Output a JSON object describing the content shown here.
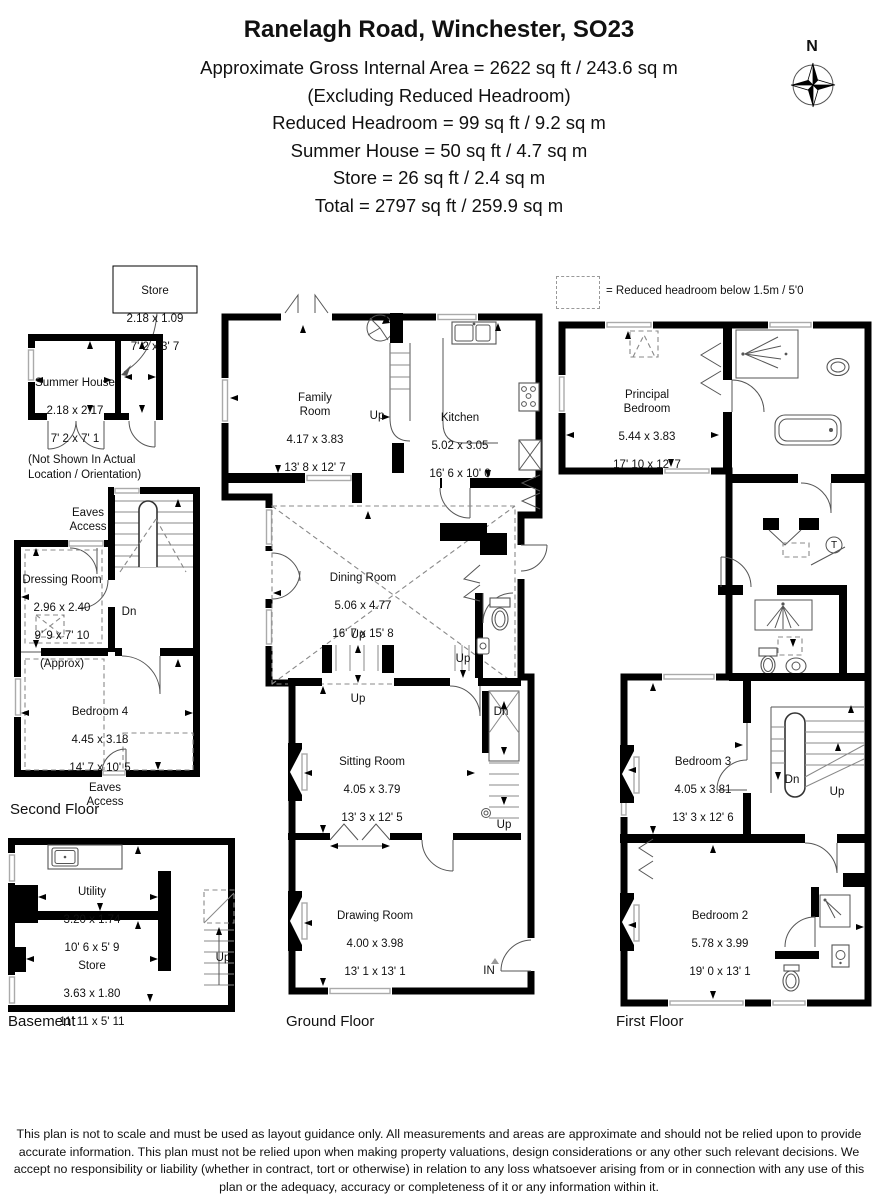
{
  "header": {
    "title": "Ranelagh Road, Winchester, SO23",
    "lines": [
      "Approximate Gross Internal Area = 2622 sq ft / 243.6 sq m",
      "(Excluding Reduced Headroom)",
      "Reduced Headroom = 99 sq ft / 9.2 sq m",
      "Summer House = 50 sq ft / 4.7 sq m",
      "Store = 26 sq ft / 2.4 sq m",
      "Total = 2797 sq ft / 259.9 sq m"
    ]
  },
  "compass": {
    "north": "N"
  },
  "legend": {
    "text": "= Reduced headroom below 1.5m / 5'0"
  },
  "floors": {
    "second": "Second Floor",
    "basement": "Basement",
    "ground": "Ground Floor",
    "first": "First Floor"
  },
  "outbuilding": {
    "store": {
      "name": "Store",
      "metric": "2.18 x 1.09",
      "imperial": "7' 2 x 3' 7"
    },
    "summer_house": {
      "name": "Summer House",
      "metric": "2.18 x 2.17",
      "imperial": "7' 2 x 7' 1"
    },
    "note": "(Not Shown In Actual\nLocation / Orientation)"
  },
  "rooms": {
    "dressing_room": {
      "name": "Dressing Room",
      "metric": "2.96 x 2.40",
      "imperial": "9' 9 x 7' 10",
      "note": "(Approx)"
    },
    "bedroom_4": {
      "name": "Bedroom 4",
      "metric": "4.45 x 3.18",
      "imperial": "14' 7 x 10' 5"
    },
    "utility": {
      "name": "Utility",
      "metric": "3.20 x 1.74",
      "imperial": "10' 6 x 5' 9"
    },
    "store_basement": {
      "name": "Store",
      "metric": "3.63 x 1.80",
      "imperial": "11' 11 x 5' 11"
    },
    "family_room": {
      "name": "Family\nRoom",
      "metric": "4.17 x 3.83",
      "imperial": "13' 8 x 12' 7"
    },
    "kitchen": {
      "name": "Kitchen",
      "metric": "5.02 x 3.05",
      "imperial": "16' 6 x 10' 0"
    },
    "dining_room": {
      "name": "Dining Room",
      "metric": "5.06 x 4.77",
      "imperial": "16' 7 x 15' 8"
    },
    "sitting_room": {
      "name": "Sitting Room",
      "metric": "4.05 x 3.79",
      "imperial": "13' 3 x 12' 5"
    },
    "drawing_room": {
      "name": "Drawing Room",
      "metric": "4.00 x 3.98",
      "imperial": "13' 1 x 13' 1"
    },
    "principal_bedroom": {
      "name": "Principal\nBedroom",
      "metric": "5.44 x 3.83",
      "imperial": "17' 10 x 12' 7"
    },
    "bedroom_3": {
      "name": "Bedroom 3",
      "metric": "4.05 x 3.81",
      "imperial": "13' 3 x 12' 6"
    },
    "bedroom_2": {
      "name": "Bedroom 2",
      "metric": "5.78 x 3.99",
      "imperial": "19' 0 x 13' 1"
    }
  },
  "annotations": {
    "eaves_access": "Eaves\nAccess",
    "up": "Up",
    "dn": "Dn",
    "entrance": "IN",
    "tank": "T"
  },
  "disclaimer": "This plan is not to scale and must be used as layout guidance only. All measurements and areas are approximate and should not be relied upon to provide accurate information. This plan must not be relied upon when making property valuations, design considerations or any other such relevant decisions. We accept no responsibility or liability (whether in contract, tort or otherwise) in relation to any loss whatsoever arising from or in connection with any use of this plan or the adequacy, accuracy or completeness of it or any information within it."
}
